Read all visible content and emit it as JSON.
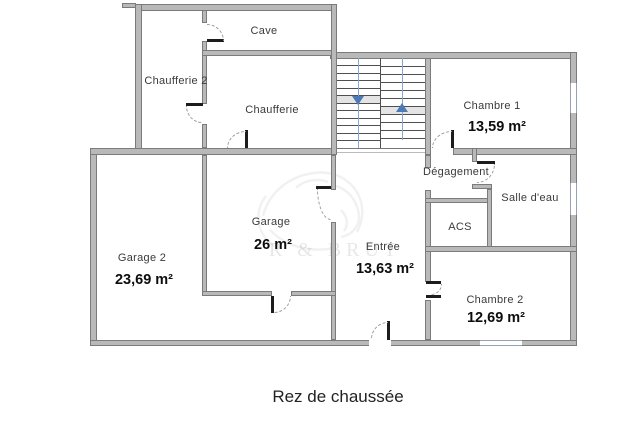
{
  "title": "Rez de chaussée",
  "watermark_text": "R & BRUT",
  "rooms": [
    {
      "name": "Cave"
    },
    {
      "name": "Chaufferie 2"
    },
    {
      "name": "Chaufferie"
    },
    {
      "name": "Chambre 1",
      "area": "13,59 m²"
    },
    {
      "name": "Dégagement"
    },
    {
      "name": "Salle d'eau"
    },
    {
      "name": "ACS"
    },
    {
      "name": "Chambre 2",
      "area": "12,69 m²"
    },
    {
      "name": "Entrée",
      "area": "13,63 m²"
    },
    {
      "name": "Garage",
      "area": "26 m²"
    },
    {
      "name": "Garage 2",
      "area": "23,69 m²"
    }
  ],
  "stairs": {
    "arrows": [
      "down",
      "up"
    ]
  },
  "colors": {
    "wall_fill": "#b9b9b9",
    "wall_edge": "#7b7b7b",
    "door_leaf": "#1c1c1c",
    "door_arc": "#9a9a9a",
    "window": "#98a0b4",
    "stair_arrow": "#4d7ab5",
    "stair_guide": "#88a6cf",
    "room_text": "#3a3a3a",
    "area_text": "#0d0d0d"
  }
}
